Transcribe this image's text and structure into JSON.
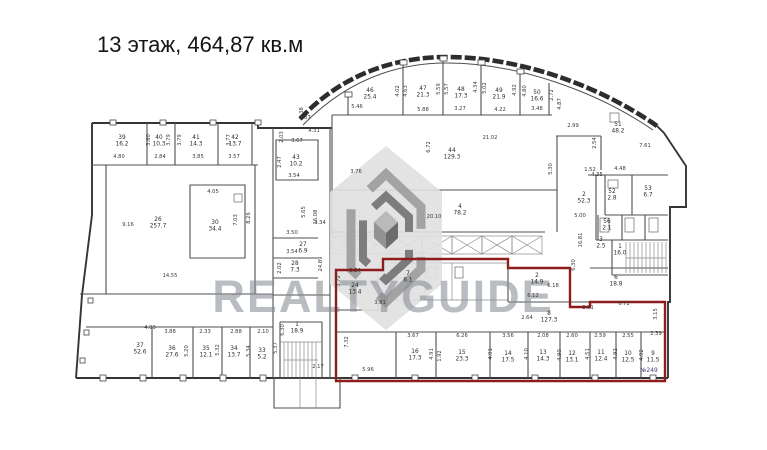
{
  "title": "13 этаж,  464,87 кв.м",
  "watermark": {
    "brand": "REALTYGUIDE",
    "logo": "hexagon-cube-logo"
  },
  "highlight": {
    "badge": "№249",
    "color": "#8e1c1c"
  },
  "plan": {
    "rooms": [
      [
        "39",
        "16.2",
        122,
        139
      ],
      [
        "40",
        "10.3",
        159,
        139
      ],
      [
        "41",
        "14.3",
        196,
        139
      ],
      [
        "42",
        "13.7",
        235,
        139
      ],
      [
        "26",
        "257.7",
        158,
        221
      ],
      [
        "30",
        "34.4",
        215,
        224
      ],
      [
        "43",
        "10.2",
        296,
        159
      ],
      [
        "27",
        "6.9",
        303,
        246
      ],
      [
        "28",
        "7.3",
        295,
        265
      ],
      [
        "1",
        "18.9",
        297,
        326
      ],
      [
        "37",
        "52.6",
        140,
        347
      ],
      [
        "36",
        "27.6",
        172,
        350
      ],
      [
        "35",
        "12.1",
        206,
        350
      ],
      [
        "34",
        "13.7",
        234,
        350
      ],
      [
        "33",
        "5.2",
        262,
        352
      ],
      [
        "46",
        "25.4",
        370,
        92
      ],
      [
        "47",
        "21.3",
        423,
        90
      ],
      [
        "48",
        "17.3",
        461,
        91
      ],
      [
        "49",
        "21.9",
        499,
        92
      ],
      [
        "50",
        "16.6",
        537,
        94
      ],
      [
        "44",
        "129.3",
        452,
        152
      ],
      [
        "4",
        "78.2",
        460,
        208
      ],
      [
        "51",
        "48.2",
        618,
        126
      ],
      [
        "2",
        "52.3",
        584,
        196
      ],
      [
        "52",
        "2.8",
        612,
        193
      ],
      [
        "53",
        "6.7",
        648,
        190
      ],
      [
        "56",
        "2.1",
        607,
        223
      ],
      [
        "3",
        "2.5",
        601,
        241
      ],
      [
        "1",
        "16.0",
        620,
        248
      ],
      [
        "6",
        "18.8",
        616,
        279
      ],
      [
        "2",
        "14.9",
        537,
        277
      ],
      [
        "24",
        "13.4",
        355,
        287
      ],
      [
        "7",
        "6.1",
        408,
        275
      ],
      [
        "8",
        "127.3",
        549,
        315
      ],
      [
        "16",
        "17.3",
        415,
        353
      ],
      [
        "15",
        "23.3",
        462,
        354
      ],
      [
        "14",
        "17.5",
        508,
        355
      ],
      [
        "13",
        "14.3",
        543,
        354
      ],
      [
        "12",
        "13.1",
        572,
        355
      ],
      [
        "11",
        "12.4",
        601,
        354
      ],
      [
        "10",
        "12.5",
        628,
        355
      ],
      [
        "9",
        "11.5",
        653,
        355
      ]
    ],
    "dims": [
      [
        "4.80",
        119,
        158,
        0
      ],
      [
        "2.84",
        160,
        158,
        0
      ],
      [
        "3.85",
        198,
        158,
        0
      ],
      [
        "3.57",
        234,
        158,
        0
      ],
      [
        "3.60",
        150,
        140,
        1
      ],
      [
        "3.79",
        170,
        140,
        1
      ],
      [
        "3.79",
        181,
        140,
        1
      ],
      [
        "3.77",
        230,
        140,
        1
      ],
      [
        "9.16",
        128,
        226,
        0
      ],
      [
        "14.55",
        170,
        277,
        0
      ],
      [
        "4.05",
        213,
        193,
        0
      ],
      [
        "7.03",
        237,
        220,
        1
      ],
      [
        "8.26",
        250,
        218,
        1
      ],
      [
        "0.87",
        305,
        119,
        0
      ],
      [
        "4.31",
        314,
        132,
        0
      ],
      [
        "3.67",
        297,
        142,
        0
      ],
      [
        "3.54",
        294,
        177,
        0
      ],
      [
        "2.03",
        283,
        137,
        1
      ],
      [
        "2.47",
        281,
        162,
        1
      ],
      [
        "3.50",
        292,
        234,
        0
      ],
      [
        "3.54",
        292,
        253,
        0
      ],
      [
        "2.02",
        281,
        268,
        1
      ],
      [
        "5.65",
        305,
        212,
        1
      ],
      [
        "16.08",
        317,
        217,
        1
      ],
      [
        "24.89",
        322,
        264,
        1
      ],
      [
        "6.30",
        284,
        330,
        1
      ],
      [
        "2.17",
        318,
        368,
        0
      ],
      [
        "4.09",
        150,
        329,
        0
      ],
      [
        "3.88",
        170,
        333,
        0
      ],
      [
        "2.33",
        205,
        333,
        0
      ],
      [
        "2.88",
        236,
        333,
        0
      ],
      [
        "2.10",
        263,
        333,
        0
      ],
      [
        "5.20",
        188,
        351,
        1
      ],
      [
        "5.32",
        219,
        350,
        1
      ],
      [
        "5.34",
        250,
        351,
        1
      ],
      [
        "5.37",
        277,
        348,
        1
      ],
      [
        "5.46",
        357,
        108,
        0
      ],
      [
        "5.88",
        423,
        111,
        0
      ],
      [
        "3.27",
        460,
        110,
        0
      ],
      [
        "4.22",
        500,
        111,
        0
      ],
      [
        "3.48",
        537,
        110,
        0
      ],
      [
        "4.02",
        399,
        91,
        1
      ],
      [
        "4.63",
        407,
        91,
        1
      ],
      [
        "5.59",
        440,
        89,
        1
      ],
      [
        "5.57",
        448,
        89,
        1
      ],
      [
        "4.34",
        477,
        87,
        1
      ],
      [
        "5.02",
        486,
        88,
        1
      ],
      [
        "4.92",
        516,
        90,
        1
      ],
      [
        "4.80",
        526,
        91,
        1
      ],
      [
        "2.72",
        553,
        95,
        1
      ],
      [
        "4.87",
        561,
        104,
        1
      ],
      [
        "2.38",
        303,
        113,
        1
      ],
      [
        "21.02",
        490,
        139,
        0
      ],
      [
        "6.72",
        430,
        147,
        1
      ],
      [
        "3.76",
        356,
        173,
        0
      ],
      [
        "3.34",
        320,
        224,
        0
      ],
      [
        "20.10",
        434,
        218,
        0
      ],
      [
        "5.30",
        552,
        169,
        1
      ],
      [
        "2.99",
        573,
        127,
        0
      ],
      [
        "2.54",
        596,
        143,
        1
      ],
      [
        "7.61",
        645,
        147,
        0
      ],
      [
        "1.52",
        590,
        171,
        0
      ],
      [
        "4.48",
        620,
        170,
        0
      ],
      [
        "4.35",
        597,
        176,
        0
      ],
      [
        "5.00",
        580,
        217,
        0
      ],
      [
        "16.81",
        582,
        240,
        1
      ],
      [
        "6.30",
        575,
        265,
        1
      ],
      [
        "3.84",
        355,
        272,
        0
      ],
      [
        "3.72",
        340,
        281,
        1
      ],
      [
        "3.81",
        380,
        304,
        0
      ],
      [
        "7.32",
        348,
        342,
        1
      ],
      [
        "5.96",
        368,
        371,
        0
      ],
      [
        "6.18",
        553,
        287,
        0
      ],
      [
        "6.12",
        533,
        297,
        0
      ],
      [
        "2.64",
        527,
        319,
        0
      ],
      [
        "2.91",
        588,
        309,
        0
      ],
      [
        "6.72",
        624,
        305,
        0
      ],
      [
        "3.15",
        657,
        314,
        1
      ],
      [
        "3.67",
        413,
        337,
        0
      ],
      [
        "6.26",
        462,
        337,
        0
      ],
      [
        "3.56",
        508,
        337,
        0
      ],
      [
        "2.08",
        543,
        337,
        0
      ],
      [
        "2.60",
        572,
        337,
        0
      ],
      [
        "2.59",
        600,
        337,
        0
      ],
      [
        "2.55",
        628,
        337,
        0
      ],
      [
        "2.39",
        656,
        335,
        0
      ],
      [
        "4.91",
        433,
        354,
        1
      ],
      [
        "1.92",
        441,
        356,
        1
      ],
      [
        "4.91",
        492,
        354,
        1
      ],
      [
        "4.10",
        528,
        354,
        1
      ],
      [
        "4.90",
        561,
        355,
        1
      ],
      [
        "4.51",
        589,
        354,
        1
      ],
      [
        "4.92",
        617,
        354,
        1
      ],
      [
        "4.92",
        643,
        355,
        1
      ]
    ]
  }
}
